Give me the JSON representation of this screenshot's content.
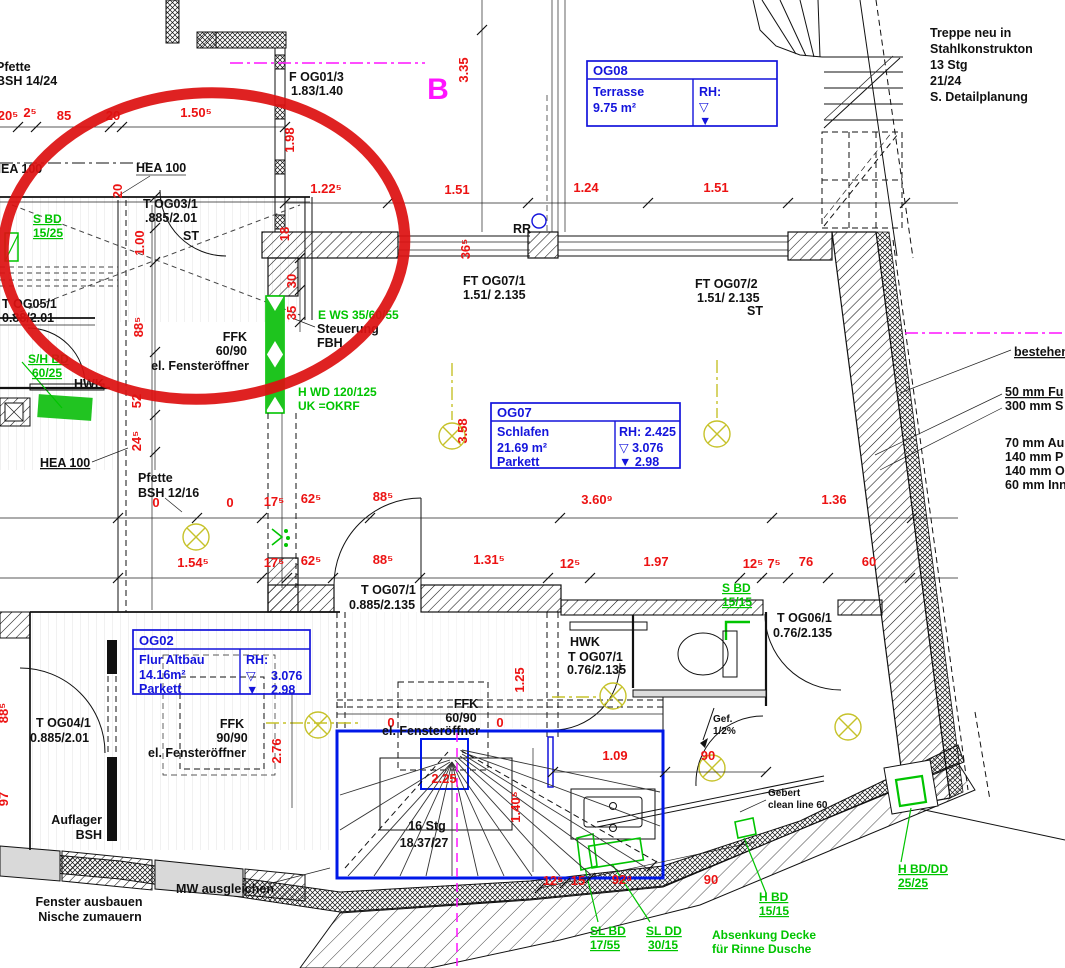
{
  "colors": {
    "dimension_red": "#ec1212",
    "installation_green": "#00c400",
    "room_box_blue": "#1414dc",
    "section_magenta": "#ff14ff",
    "lamp_yellow": "#c6c22a",
    "marker_red": "#dd1111"
  },
  "marker_circle": {
    "cx": 204,
    "cy": 246,
    "rx": 201,
    "ry": 153
  },
  "section_mark": "B",
  "rooms": {
    "og08": {
      "id": "OG08",
      "name": "Terrasse",
      "area": "9.75 m²",
      "rh": "RH:",
      "tri_open": "▽",
      "tri_fill": "▼"
    },
    "og07": {
      "id": "OG07",
      "name": "Schlafen",
      "area": "21.69 m²",
      "floor": "Parkett",
      "rh": "RH: 2.425",
      "lvl_open": "▽  3.076",
      "lvl_fill": "▼  2.98"
    },
    "og02": {
      "id": "OG02",
      "name": "Flur Altbau",
      "area": "14.16m²",
      "floor": "Parkett",
      "rh": "RH:",
      "tri_open": "▽",
      "val_open": "3.076",
      "tri_fill": "▼",
      "val_fill": "2.98"
    }
  },
  "texts": [
    {
      "t": "20⁵",
      "x": 8,
      "y": 120,
      "c": "red"
    },
    {
      "t": "2⁵",
      "x": 30,
      "y": 117,
      "c": "red"
    },
    {
      "t": "85",
      "x": 64,
      "y": 120,
      "c": "red"
    },
    {
      "t": "20",
      "x": 113,
      "y": 120,
      "c": "red"
    },
    {
      "t": "1.50⁵",
      "x": 196,
      "y": 117,
      "c": "red"
    },
    {
      "t": "1.98",
      "x": 294,
      "y": 140,
      "c": "red",
      "r": -90
    },
    {
      "t": "1.22⁵",
      "x": 326,
      "y": 193,
      "c": "red"
    },
    {
      "t": "1.51",
      "x": 457,
      "y": 194,
      "c": "red"
    },
    {
      "t": "1.24",
      "x": 586,
      "y": 192,
      "c": "red"
    },
    {
      "t": "1.51",
      "x": 716,
      "y": 192,
      "c": "red"
    },
    {
      "t": "3.35",
      "x": 468,
      "y": 70,
      "c": "red",
      "r": -90
    },
    {
      "t": "36⁵",
      "x": 470,
      "y": 249,
      "c": "red",
      "r": -90
    },
    {
      "t": "18",
      "x": 289,
      "y": 234,
      "c": "red",
      "r": -90
    },
    {
      "t": "20",
      "x": 122,
      "y": 191,
      "c": "red",
      "r": -90
    },
    {
      "t": "1.00",
      "x": 144,
      "y": 243,
      "c": "red",
      "r": -90
    },
    {
      "t": "88⁵",
      "x": 143,
      "y": 327,
      "c": "red",
      "r": -90
    },
    {
      "t": "52",
      "x": 141,
      "y": 401,
      "c": "red",
      "r": -90
    },
    {
      "t": "24⁵",
      "x": 141,
      "y": 441,
      "c": "red",
      "r": -90
    },
    {
      "t": "30",
      "x": 296,
      "y": 281,
      "c": "red",
      "r": -90
    },
    {
      "t": "35",
      "x": 296,
      "y": 313,
      "c": "red",
      "r": -90
    },
    {
      "t": "3.58",
      "x": 467,
      "y": 431,
      "c": "red",
      "r": -90
    },
    {
      "t": "0",
      "x": 156,
      "y": 507,
      "c": "red"
    },
    {
      "t": "0",
      "x": 230,
      "y": 507,
      "c": "red"
    },
    {
      "t": "17⁵",
      "x": 274,
      "y": 506,
      "c": "red"
    },
    {
      "t": "62⁵",
      "x": 311,
      "y": 503,
      "c": "red"
    },
    {
      "t": "88⁵",
      "x": 383,
      "y": 501,
      "c": "red"
    },
    {
      "t": "3.60⁹",
      "x": 597,
      "y": 504,
      "c": "red"
    },
    {
      "t": "1.36",
      "x": 834,
      "y": 504,
      "c": "red"
    },
    {
      "t": "1.54⁵",
      "x": 193,
      "y": 567,
      "c": "red"
    },
    {
      "t": "17⁵",
      "x": 274,
      "y": 567,
      "c": "red"
    },
    {
      "t": "62⁵",
      "x": 311,
      "y": 565,
      "c": "red"
    },
    {
      "t": "88⁵",
      "x": 383,
      "y": 564,
      "c": "red"
    },
    {
      "t": "1.31⁵",
      "x": 489,
      "y": 564,
      "c": "red"
    },
    {
      "t": "12⁵",
      "x": 570,
      "y": 568,
      "c": "red"
    },
    {
      "t": "1.97",
      "x": 656,
      "y": 566,
      "c": "red"
    },
    {
      "t": "12⁵",
      "x": 753,
      "y": 568,
      "c": "red"
    },
    {
      "t": "7⁵",
      "x": 774,
      "y": 568,
      "c": "red"
    },
    {
      "t": "76",
      "x": 806,
      "y": 566,
      "c": "red"
    },
    {
      "t": "60",
      "x": 869,
      "y": 566,
      "c": "red"
    },
    {
      "t": "88⁵",
      "x": 8,
      "y": 713,
      "c": "red",
      "r": -90
    },
    {
      "t": "97",
      "x": 8,
      "y": 799,
      "c": "red",
      "r": -90
    },
    {
      "t": "2.76",
      "x": 281,
      "y": 751,
      "c": "red",
      "r": -90
    },
    {
      "t": "1.25",
      "x": 524,
      "y": 680,
      "c": "red",
      "r": -90
    },
    {
      "t": "0",
      "x": 391,
      "y": 727,
      "c": "red"
    },
    {
      "t": "0",
      "x": 500,
      "y": 727,
      "c": "red"
    },
    {
      "t": "2.25",
      "x": 444,
      "y": 783,
      "c": "red"
    },
    {
      "t": "1.40⁵",
      "x": 520,
      "y": 807,
      "c": "red",
      "r": -90
    },
    {
      "t": "12⁵",
      "x": 553,
      "y": 885,
      "c": "red"
    },
    {
      "t": "15",
      "x": 578,
      "y": 885,
      "c": "red"
    },
    {
      "t": "92⁸",
      "x": 622,
      "y": 884,
      "c": "red"
    },
    {
      "t": "90",
      "x": 711,
      "y": 884,
      "c": "red"
    },
    {
      "t": "1.09",
      "x": 615,
      "y": 760,
      "c": "red"
    },
    {
      "t": "90",
      "x": 708,
      "y": 760,
      "c": "red"
    },
    {
      "t": "Pfette",
      "x": -4,
      "y": 71,
      "a": "start"
    },
    {
      "t": "BSH 14/24",
      "x": -4,
      "y": 85,
      "a": "start"
    },
    {
      "t": "HEA 100",
      "x": -8,
      "y": 173,
      "a": "start"
    },
    {
      "t": "HEA 100",
      "x": 136,
      "y": 172,
      "a": "start"
    },
    {
      "t": "HEA 100",
      "x": 40,
      "y": 467,
      "a": "start",
      "u": 1
    },
    {
      "t": "T OG03/1",
      "x": 143,
      "y": 208,
      "a": "start"
    },
    {
      "t": ".885/2.01",
      "x": 145,
      "y": 222,
      "a": "start"
    },
    {
      "t": "ST",
      "x": 183,
      "y": 240,
      "a": "start"
    },
    {
      "t": "F OG01/3",
      "x": 289,
      "y": 81,
      "a": "start"
    },
    {
      "t": "1.83/1.40",
      "x": 291,
      "y": 95,
      "a": "start"
    },
    {
      "t": "T OG05/1",
      "x": 2,
      "y": 308,
      "a": "start"
    },
    {
      "t": "0.88/2.01",
      "x": 2,
      "y": 322,
      "a": "start"
    },
    {
      "t": "HWK",
      "x": 74,
      "y": 388,
      "a": "start"
    },
    {
      "t": "FFK",
      "x": 247,
      "y": 341,
      "a": "end"
    },
    {
      "t": "60/90",
      "x": 247,
      "y": 355,
      "a": "end"
    },
    {
      "t": "el. Fensteröffner",
      "x": 249,
      "y": 370,
      "a": "end"
    },
    {
      "t": "Steuerung",
      "x": 317,
      "y": 333,
      "a": "start"
    },
    {
      "t": "FBH",
      "x": 317,
      "y": 347,
      "a": "start"
    },
    {
      "t": "FT OG07/1",
      "x": 463,
      "y": 285,
      "a": "start"
    },
    {
      "t": "1.51/ 2.135",
      "x": 463,
      "y": 299,
      "a": "start"
    },
    {
      "t": "FT OG07/2",
      "x": 695,
      "y": 288,
      "a": "start"
    },
    {
      "t": "1.51/ 2.135",
      "x": 697,
      "y": 302,
      "a": "start"
    },
    {
      "t": "ST",
      "x": 747,
      "y": 315,
      "a": "start"
    },
    {
      "t": "Treppe neu in",
      "x": 930,
      "y": 37,
      "a": "start"
    },
    {
      "t": "Stahlkonstrukton",
      "x": 930,
      "y": 53,
      "a": "start"
    },
    {
      "t": "13 Stg",
      "x": 930,
      "y": 69,
      "a": "start"
    },
    {
      "t": "21/24",
      "x": 930,
      "y": 85,
      "a": "start"
    },
    {
      "t": "S. Detailplanung",
      "x": 930,
      "y": 101,
      "a": "start"
    },
    {
      "t": "bestehend",
      "x": 1014,
      "y": 356,
      "a": "start",
      "u": 1
    },
    {
      "t": "50 mm Fu",
      "x": 1005,
      "y": 396,
      "a": "start",
      "u": 1
    },
    {
      "t": "300 mm S",
      "x": 1005,
      "y": 410,
      "a": "start"
    },
    {
      "t": "70 mm Au",
      "x": 1005,
      "y": 447,
      "a": "start"
    },
    {
      "t": "140 mm P",
      "x": 1005,
      "y": 461,
      "a": "start"
    },
    {
      "t": "140 mm O",
      "x": 1005,
      "y": 475,
      "a": "start"
    },
    {
      "t": "60 mm Inn",
      "x": 1005,
      "y": 489,
      "a": "start"
    },
    {
      "t": "Pfette",
      "x": 138,
      "y": 482,
      "a": "start"
    },
    {
      "t": "BSH 12/16",
      "x": 138,
      "y": 497,
      "a": "start"
    },
    {
      "t": "T OG07/1",
      "x": 361,
      "y": 594,
      "a": "start"
    },
    {
      "t": "0.885/2.135",
      "x": 349,
      "y": 609,
      "a": "start"
    },
    {
      "t": "T OG06/1",
      "x": 777,
      "y": 622,
      "a": "start"
    },
    {
      "t": "0.76/2.135",
      "x": 773,
      "y": 637,
      "a": "start"
    },
    {
      "t": "HWK",
      "x": 570,
      "y": 646,
      "a": "start"
    },
    {
      "t": "T OG07/1",
      "x": 568,
      "y": 661,
      "a": "start"
    },
    {
      "t": "0.76/2.135",
      "x": 567,
      "y": 674,
      "a": "start"
    },
    {
      "t": "Gef.",
      "x": 713,
      "y": 722,
      "a": "start",
      "c": "sm"
    },
    {
      "t": "1/2%",
      "x": 713,
      "y": 734,
      "a": "start",
      "c": "sm"
    },
    {
      "t": "Gebert",
      "x": 768,
      "y": 796,
      "a": "start",
      "c": "sm"
    },
    {
      "t": "clean line 60",
      "x": 768,
      "y": 808,
      "a": "start",
      "c": "sm"
    },
    {
      "t": "T OG04/1",
      "x": 36,
      "y": 727,
      "a": "start"
    },
    {
      "t": "0.885/2.01",
      "x": 30,
      "y": 742,
      "a": "start"
    },
    {
      "t": "Auflager",
      "x": 102,
      "y": 824,
      "a": "end"
    },
    {
      "t": "BSH",
      "x": 102,
      "y": 839,
      "a": "end"
    },
    {
      "t": "Fenster ausbauen",
      "x": 89,
      "y": 906
    },
    {
      "t": "Nische zumauern",
      "x": 90,
      "y": 921
    },
    {
      "t": "MW ausgleichen",
      "x": 225,
      "y": 893
    },
    {
      "t": "FFK",
      "x": 232,
      "y": 728
    },
    {
      "t": "90/90",
      "x": 232,
      "y": 742
    },
    {
      "t": "el. Fensteröffner",
      "x": 197,
      "y": 757
    },
    {
      "t": "FFK",
      "x": 466,
      "y": 708
    },
    {
      "t": "60/90",
      "x": 461,
      "y": 722
    },
    {
      "t": "el. Fensteröffner",
      "x": 431,
      "y": 735
    },
    {
      "t": "16 Stg",
      "x": 427,
      "y": 830
    },
    {
      "t": "18.37/27",
      "x": 424,
      "y": 847
    },
    {
      "t": "RR",
      "x": 513,
      "y": 233,
      "a": "start"
    },
    {
      "t": "S BD",
      "x": 33,
      "y": 223,
      "a": "start",
      "c": "grn",
      "u": 1
    },
    {
      "t": "15/25",
      "x": 33,
      "y": 237,
      "a": "start",
      "c": "grn",
      "u": 1
    },
    {
      "t": "S/H BD",
      "x": 28,
      "y": 363,
      "a": "start",
      "c": "grn",
      "u": 1
    },
    {
      "t": "60/25",
      "x": 32,
      "y": 377,
      "a": "start",
      "c": "grn",
      "u": 1
    },
    {
      "t": "E WS 35/60/55",
      "x": 318,
      "y": 319,
      "a": "start",
      "c": "grn"
    },
    {
      "t": "H WD 120/125",
      "x": 298,
      "y": 396,
      "a": "start",
      "c": "grn"
    },
    {
      "t": "UK =OKRF",
      "x": 298,
      "y": 410,
      "a": "start",
      "c": "grn"
    },
    {
      "t": "S BD",
      "x": 722,
      "y": 592,
      "a": "start",
      "c": "grn",
      "u": 1
    },
    {
      "t": "15/15",
      "x": 722,
      "y": 606,
      "a": "start",
      "c": "grn",
      "u": 1
    },
    {
      "t": "H BD",
      "x": 759,
      "y": 901,
      "a": "start",
      "c": "grn",
      "u": 1
    },
    {
      "t": "15/15",
      "x": 759,
      "y": 915,
      "a": "start",
      "c": "grn",
      "u": 1
    },
    {
      "t": "SL BD",
      "x": 590,
      "y": 935,
      "a": "start",
      "c": "grn",
      "u": 1
    },
    {
      "t": "17/55",
      "x": 590,
      "y": 949,
      "a": "start",
      "c": "grn",
      "u": 1
    },
    {
      "t": "SL DD",
      "x": 646,
      "y": 935,
      "a": "start",
      "c": "grn",
      "u": 1
    },
    {
      "t": "30/15",
      "x": 648,
      "y": 949,
      "a": "start",
      "c": "grn",
      "u": 1
    },
    {
      "t": "Absenkung Decke",
      "x": 712,
      "y": 939,
      "a": "start",
      "c": "grn"
    },
    {
      "t": "für Rinne Dusche",
      "x": 712,
      "y": 953,
      "a": "start",
      "c": "grn"
    },
    {
      "t": "H BD/DD",
      "x": 898,
      "y": 873,
      "a": "start",
      "c": "grn",
      "u": 1
    },
    {
      "t": "25/25",
      "x": 898,
      "y": 887,
      "a": "start",
      "c": "grn",
      "u": 1
    },
    {
      "t": "B",
      "x": 438,
      "y": 99,
      "c": "mag"
    }
  ]
}
